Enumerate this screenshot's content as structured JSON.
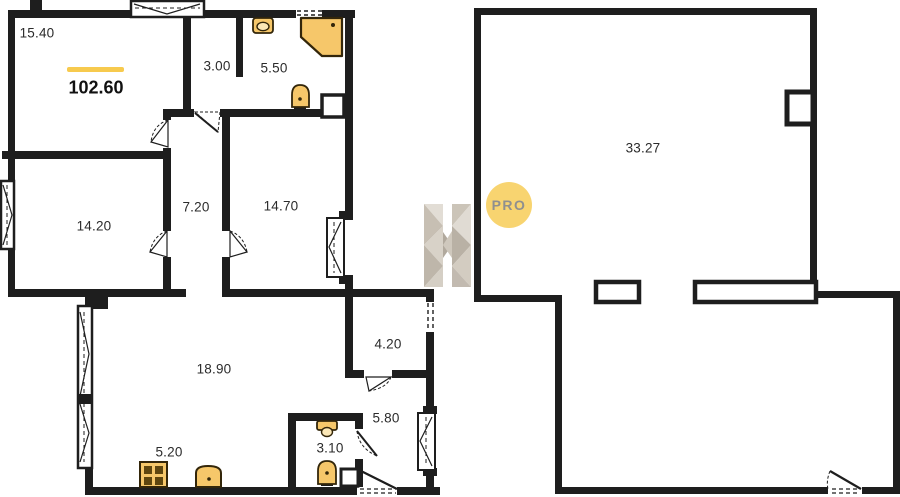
{
  "plan": {
    "type": "apartment-floor-plan",
    "total_area": "102.60",
    "rooms": [
      {
        "id": "room-15-40",
        "area": "15.40"
      },
      {
        "id": "hall-3-00",
        "area": "3.00"
      },
      {
        "id": "bath-5-50",
        "area": "5.50"
      },
      {
        "id": "corridor-7-20",
        "area": "7.20"
      },
      {
        "id": "room-14-20",
        "area": "14.20"
      },
      {
        "id": "room-14-70",
        "area": "14.70"
      },
      {
        "id": "living-18-90",
        "area": "18.90"
      },
      {
        "id": "kitchen-5-20",
        "area": "5.20"
      },
      {
        "id": "bath-3-10",
        "area": "3.10"
      },
      {
        "id": "hall-5-80",
        "area": "5.80"
      },
      {
        "id": "room-4-20",
        "area": "4.20"
      },
      {
        "id": "room-33-27",
        "area": "33.27"
      }
    ],
    "watermark": {
      "text": "PRO"
    },
    "icons": [
      "toilet-icon",
      "shower-icon",
      "sink-icon",
      "stove-icon",
      "duct-icon",
      "door-icon",
      "window-icon"
    ],
    "colors": {
      "wall": "#1e1e1e",
      "fixture_fill": "#f6c76a",
      "fixture_dark": "#5f460f",
      "accent_underline": "#f7ca4e",
      "badge_bg": "#f8d470",
      "badge_text": "#8f8f8f",
      "watermark_gray": "#c7bfb3"
    }
  }
}
